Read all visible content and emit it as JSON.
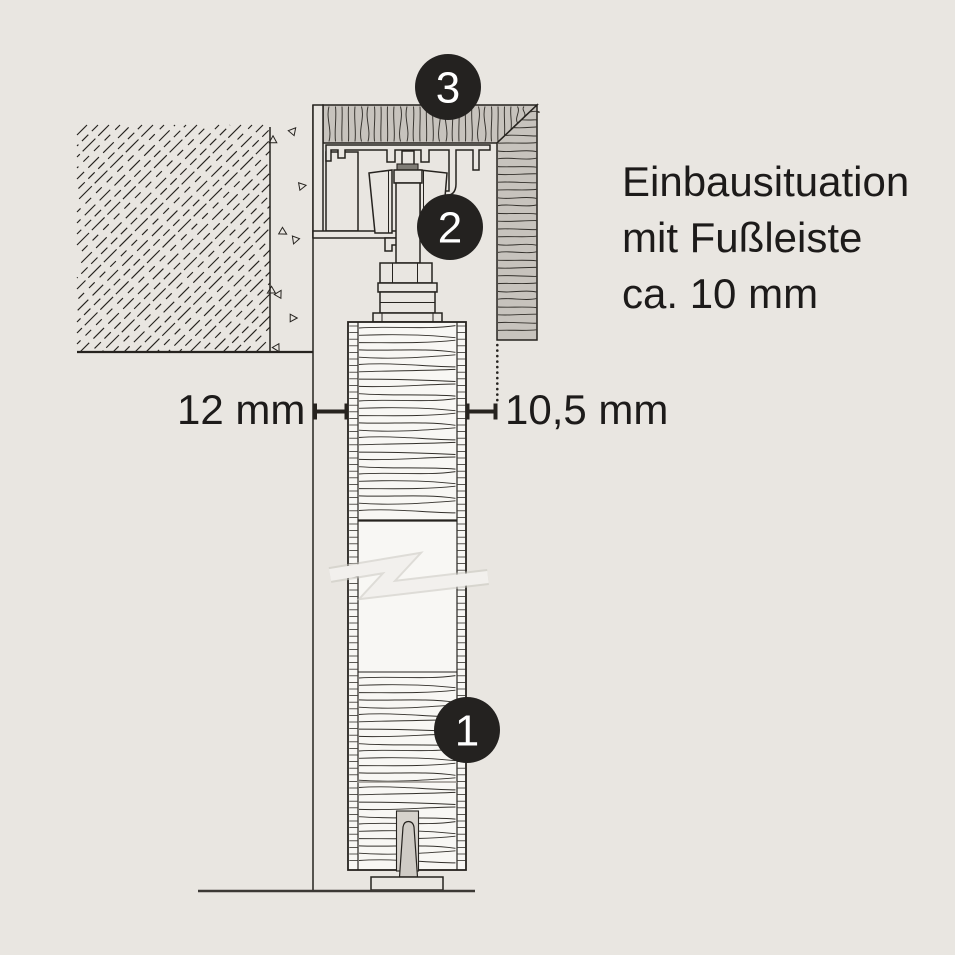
{
  "title_lines": [
    "Einbausituation",
    "mit Fußleiste",
    "ca. 10 mm"
  ],
  "dimension_labels": {
    "gap_left": "12 mm",
    "gap_right": "10,5 mm"
  },
  "callouts": {
    "track_cover": "3",
    "roller": "2",
    "door_panel": "1"
  },
  "colors": {
    "background": "#e9e6e1",
    "ink": "#26231f",
    "wood": "#c7c3bd",
    "slot": "#d6d2cc",
    "pin": "#cfcbc5",
    "door_white": "#f8f7f4",
    "break_white": "#f2f0ed",
    "badge": "#242220",
    "badge_text": "#ffffff"
  }
}
